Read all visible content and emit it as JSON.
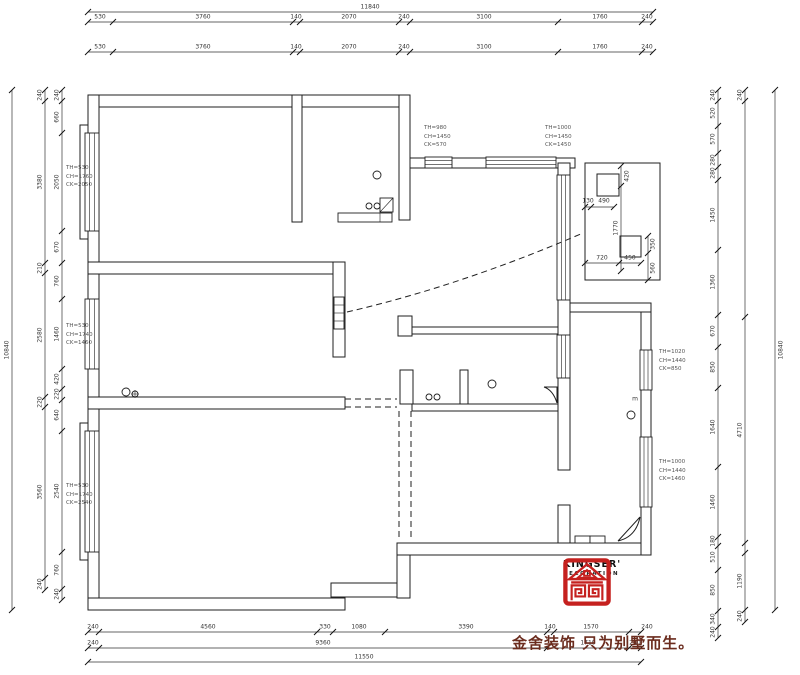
{
  "logo": {
    "brand": "KINGSER'",
    "sub": "DECORATION",
    "slogan": "金舍装饰 只为别墅而生。",
    "red": "#c5211f"
  },
  "annotations": [
    {
      "x": 66,
      "y": 164,
      "lines": [
        "TH=530",
        "CH=1760",
        "CK=2050"
      ]
    },
    {
      "x": 66,
      "y": 322,
      "lines": [
        "TH=530",
        "CH=1740",
        "CK=1460"
      ]
    },
    {
      "x": 66,
      "y": 482,
      "lines": [
        "TH=530",
        "CH=1740",
        "CK=2540"
      ]
    },
    {
      "x": 424,
      "y": 124,
      "lines": [
        "TH=980",
        "CH=1450",
        "CK=570"
      ]
    },
    {
      "x": 545,
      "y": 124,
      "lines": [
        "TH=1000",
        "CH=1450",
        "CK=1450"
      ]
    },
    {
      "x": 659,
      "y": 348,
      "lines": [
        "TH=1020",
        "CH=1440",
        "CK=850"
      ]
    },
    {
      "x": 659,
      "y": 458,
      "lines": [
        "TH=1000",
        "CH=1440",
        "CK=1460"
      ]
    }
  ],
  "dim_labels": [
    {
      "t": "11840",
      "x": 370,
      "y": 7
    },
    {
      "t": "530",
      "x": 100,
      "y": 17
    },
    {
      "t": "3760",
      "x": 203,
      "y": 17
    },
    {
      "t": "140",
      "x": 296,
      "y": 17
    },
    {
      "t": "2070",
      "x": 349,
      "y": 17
    },
    {
      "t": "240",
      "x": 404,
      "y": 17
    },
    {
      "t": "3100",
      "x": 484,
      "y": 17
    },
    {
      "t": "1760",
      "x": 600,
      "y": 17
    },
    {
      "t": "240",
      "x": 647,
      "y": 17
    },
    {
      "t": "530",
      "x": 100,
      "y": 47
    },
    {
      "t": "3760",
      "x": 203,
      "y": 47
    },
    {
      "t": "140",
      "x": 296,
      "y": 47
    },
    {
      "t": "2070",
      "x": 349,
      "y": 47
    },
    {
      "t": "240",
      "x": 404,
      "y": 47
    },
    {
      "t": "3100",
      "x": 484,
      "y": 47
    },
    {
      "t": "1760",
      "x": 600,
      "y": 47
    },
    {
      "t": "240",
      "x": 647,
      "y": 47
    },
    {
      "t": "10840",
      "x": 7,
      "y": 350,
      "v": 1
    },
    {
      "t": "240",
      "x": 40,
      "y": 95,
      "v": 1
    },
    {
      "t": "3380",
      "x": 40,
      "y": 182,
      "v": 1
    },
    {
      "t": "210",
      "x": 40,
      "y": 268,
      "v": 1
    },
    {
      "t": "2580",
      "x": 40,
      "y": 335,
      "v": 1
    },
    {
      "t": "220",
      "x": 40,
      "y": 402,
      "v": 1
    },
    {
      "t": "3560",
      "x": 40,
      "y": 492,
      "v": 1
    },
    {
      "t": "240",
      "x": 40,
      "y": 584,
      "v": 1
    },
    {
      "t": "240",
      "x": 57,
      "y": 95,
      "v": 1
    },
    {
      "t": "660",
      "x": 57,
      "y": 117,
      "v": 1
    },
    {
      "t": "2050",
      "x": 57,
      "y": 182,
      "v": 1
    },
    {
      "t": "670",
      "x": 57,
      "y": 247,
      "v": 1
    },
    {
      "t": "760",
      "x": 57,
      "y": 281,
      "v": 1
    },
    {
      "t": "1460",
      "x": 57,
      "y": 334,
      "v": 1
    },
    {
      "t": "420",
      "x": 57,
      "y": 379,
      "v": 1
    },
    {
      "t": "220",
      "x": 57,
      "y": 394,
      "v": 1
    },
    {
      "t": "640",
      "x": 57,
      "y": 415,
      "v": 1
    },
    {
      "t": "2540",
      "x": 57,
      "y": 491,
      "v": 1
    },
    {
      "t": "760",
      "x": 57,
      "y": 570,
      "v": 1
    },
    {
      "t": "240",
      "x": 57,
      "y": 594,
      "v": 1
    },
    {
      "t": "240",
      "x": 713,
      "y": 95,
      "v": 1
    },
    {
      "t": "520",
      "x": 713,
      "y": 113,
      "v": 1
    },
    {
      "t": "570",
      "x": 713,
      "y": 139,
      "v": 1
    },
    {
      "t": "280",
      "x": 713,
      "y": 160,
      "v": 1
    },
    {
      "t": "280",
      "x": 713,
      "y": 173,
      "v": 1
    },
    {
      "t": "1450",
      "x": 713,
      "y": 215,
      "v": 1
    },
    {
      "t": "1360",
      "x": 713,
      "y": 282,
      "v": 1
    },
    {
      "t": "670",
      "x": 713,
      "y": 331,
      "v": 1
    },
    {
      "t": "850",
      "x": 713,
      "y": 367,
      "v": 1
    },
    {
      "t": "1640",
      "x": 713,
      "y": 427,
      "v": 1
    },
    {
      "t": "1460",
      "x": 713,
      "y": 502,
      "v": 1
    },
    {
      "t": "180",
      "x": 713,
      "y": 541,
      "v": 1
    },
    {
      "t": "510",
      "x": 713,
      "y": 557,
      "v": 1
    },
    {
      "t": "850",
      "x": 713,
      "y": 590,
      "v": 1
    },
    {
      "t": "340",
      "x": 713,
      "y": 619,
      "v": 1
    },
    {
      "t": "240",
      "x": 713,
      "y": 632,
      "v": 1
    },
    {
      "t": "240",
      "x": 740,
      "y": 95,
      "v": 1
    },
    {
      "t": "4710",
      "x": 740,
      "y": 430,
      "v": 1
    },
    {
      "t": "1190",
      "x": 740,
      "y": 581,
      "v": 1
    },
    {
      "t": "240",
      "x": 740,
      "y": 616,
      "v": 1
    },
    {
      "t": "10840",
      "x": 781,
      "y": 350,
      "v": 1
    },
    {
      "t": "240",
      "x": 93,
      "y": 627
    },
    {
      "t": "4560",
      "x": 208,
      "y": 627
    },
    {
      "t": "330",
      "x": 325,
      "y": 627
    },
    {
      "t": "1080",
      "x": 359,
      "y": 627
    },
    {
      "t": "3390",
      "x": 466,
      "y": 627
    },
    {
      "t": "140",
      "x": 550,
      "y": 627
    },
    {
      "t": "1570",
      "x": 591,
      "y": 627
    },
    {
      "t": "240",
      "x": 647,
      "y": 627
    },
    {
      "t": "240",
      "x": 93,
      "y": 643
    },
    {
      "t": "9360",
      "x": 323,
      "y": 643
    },
    {
      "t": "1710",
      "x": 588,
      "y": 643
    },
    {
      "t": "240",
      "x": 635,
      "y": 643
    },
    {
      "t": "11550",
      "x": 364,
      "y": 657
    },
    {
      "t": "130",
      "x": 588,
      "y": 201
    },
    {
      "t": "490",
      "x": 604,
      "y": 201
    },
    {
      "t": "420",
      "x": 627,
      "y": 176,
      "v": 1
    },
    {
      "t": "1770",
      "x": 616,
      "y": 228,
      "v": 1
    },
    {
      "t": "350",
      "x": 653,
      "y": 244,
      "v": 1
    },
    {
      "t": "560",
      "x": 653,
      "y": 268,
      "v": 1
    },
    {
      "t": "720",
      "x": 602,
      "y": 258
    },
    {
      "t": "450",
      "x": 630,
      "y": 258
    },
    {
      "t": "m",
      "x": 635,
      "y": 399
    }
  ]
}
